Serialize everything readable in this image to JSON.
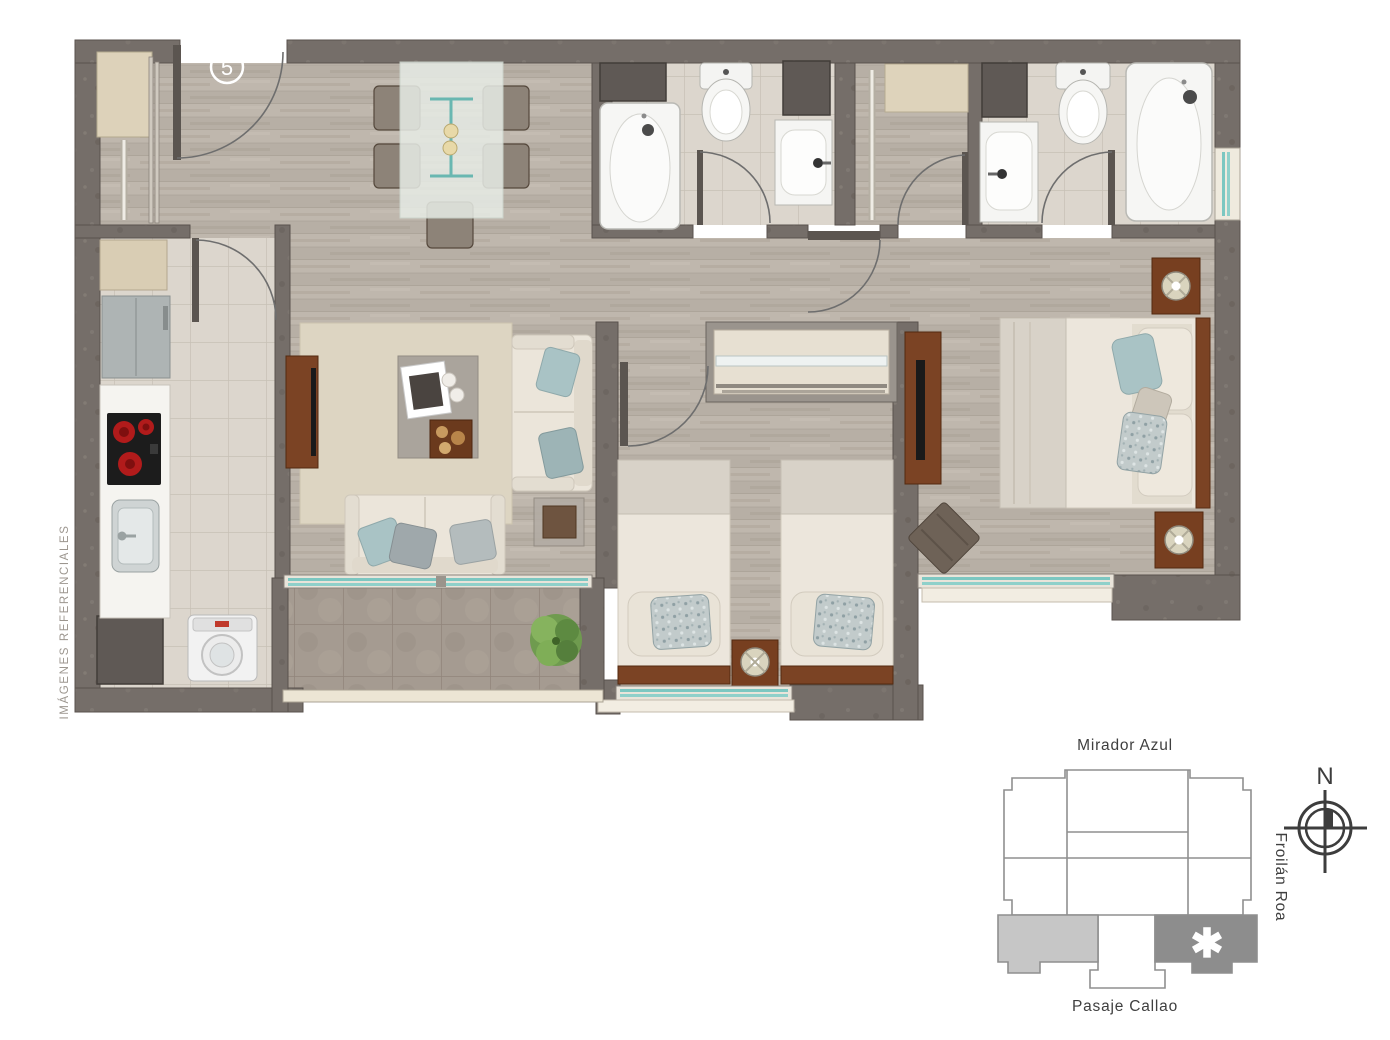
{
  "watermark": "IMÁGENES REFERENCIALES",
  "unit_badge": "5",
  "locator": {
    "street_top": "Mirador Azul",
    "street_right": "Froilán Roa",
    "street_bottom": "Pasaje Callao",
    "compass_north": "N",
    "unit_marker": "✱"
  },
  "colors": {
    "wall": "#756e69",
    "wood_floor": "#b7afa5",
    "tile_floor": "#dcd6cd",
    "stone_floor": "#a59b91",
    "rug": "#ddd5c2",
    "glass_accent": "#7cc7c1",
    "furniture_brown": "#7b4324",
    "fabric_cream": "#ece6dc",
    "pillow_blue": "#a9c3c5",
    "locator_unit_light": "#c6c6c6",
    "locator_unit_dark": "#8d8d8d",
    "cooktop_burner": "#b11b1b"
  }
}
